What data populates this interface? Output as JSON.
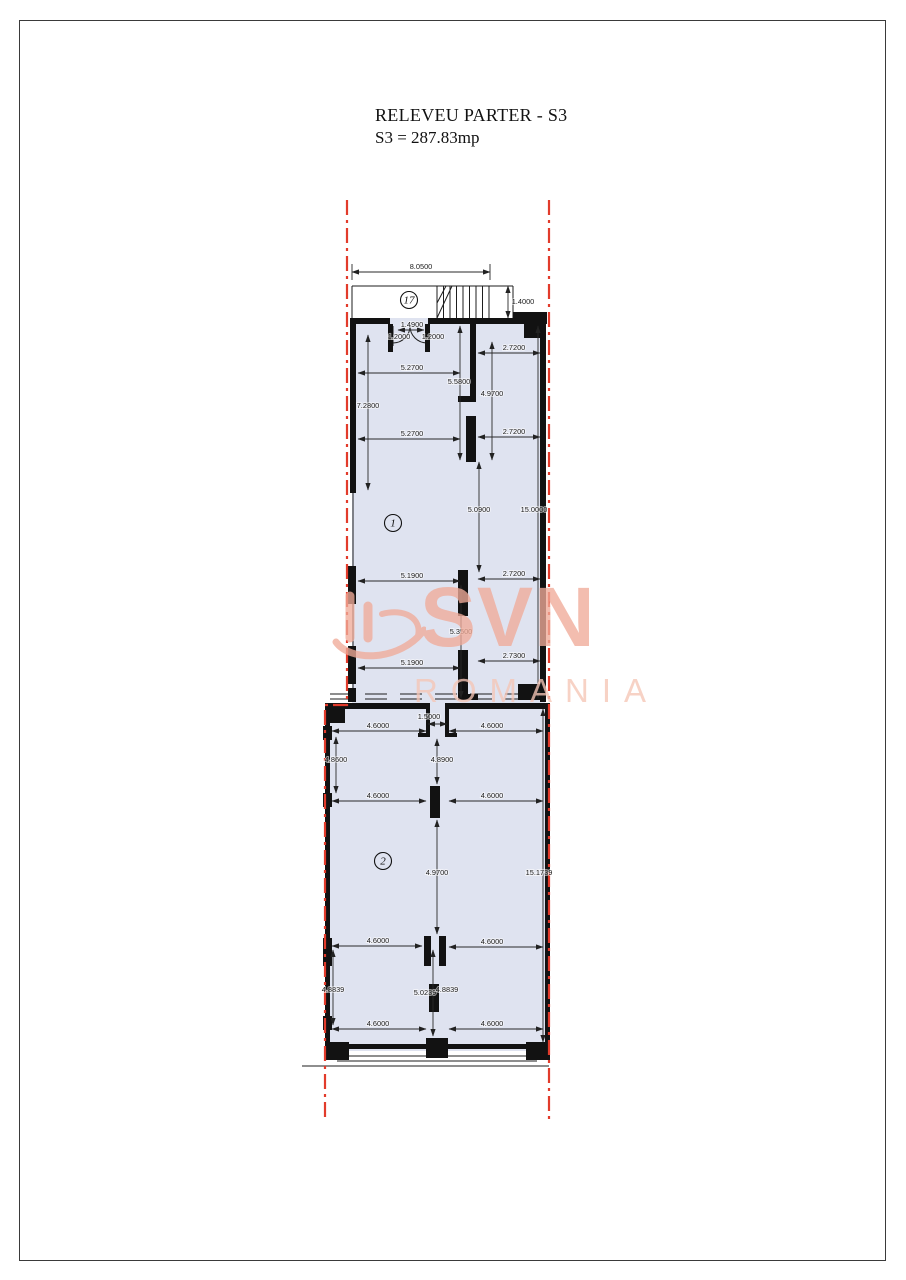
{
  "page": {
    "title_line1": "RELEVEU PARTER - S3",
    "title_line2": "S3 = 287.83mp"
  },
  "watermark": {
    "main": "SVN",
    "sub": "ROMANIA",
    "color_main": "#f0ab99",
    "color_sub": "#f6c6b6"
  },
  "colors": {
    "floor_fill": "#dfe3f0",
    "wall": "#121212",
    "boundary_red": "#e23b2b",
    "dim_line": "#2a2a2a"
  },
  "rooms": [
    {
      "label": "17",
      "x": 409,
      "y": 300
    },
    {
      "label": "1",
      "x": 393,
      "y": 523
    },
    {
      "label": "2",
      "x": 383,
      "y": 861
    }
  ],
  "dimensions": [
    {
      "text": "8.0500",
      "x": 421,
      "y": 269
    },
    {
      "text": "1.4000",
      "x": 523,
      "y": 304
    },
    {
      "text": "1.4900",
      "x": 412,
      "y": 327
    },
    {
      "text": "1.2000",
      "x": 399,
      "y": 339
    },
    {
      "text": "1.2000",
      "x": 433,
      "y": 339
    },
    {
      "text": "2.7200",
      "x": 514,
      "y": 350
    },
    {
      "text": "5.2700",
      "x": 412,
      "y": 370
    },
    {
      "text": "5.5800",
      "x": 459,
      "y": 384
    },
    {
      "text": "4.9700",
      "x": 492,
      "y": 396
    },
    {
      "text": "7.2800",
      "x": 368,
      "y": 408
    },
    {
      "text": "2.7200",
      "x": 514,
      "y": 434
    },
    {
      "text": "5.2700",
      "x": 412,
      "y": 436
    },
    {
      "text": "5.0900",
      "x": 479,
      "y": 512
    },
    {
      "text": "15.0000",
      "x": 534,
      "y": 512
    },
    {
      "text": "2.7200",
      "x": 514,
      "y": 576
    },
    {
      "text": "5.1900",
      "x": 412,
      "y": 578
    },
    {
      "text": "5.3500",
      "x": 461,
      "y": 634
    },
    {
      "text": "2.7300",
      "x": 514,
      "y": 658
    },
    {
      "text": "5.1900",
      "x": 412,
      "y": 665
    },
    {
      "text": "1.5000",
      "x": 429,
      "y": 719
    },
    {
      "text": "4.6000",
      "x": 378,
      "y": 728
    },
    {
      "text": "4.6000",
      "x": 492,
      "y": 728
    },
    {
      "text": "4.8600",
      "x": 336,
      "y": 762
    },
    {
      "text": "4.8900",
      "x": 442,
      "y": 762
    },
    {
      "text": "4.6000",
      "x": 378,
      "y": 798
    },
    {
      "text": "4.6000",
      "x": 492,
      "y": 798
    },
    {
      "text": "4.9700",
      "x": 437,
      "y": 875
    },
    {
      "text": "15.1739",
      "x": 539,
      "y": 875
    },
    {
      "text": "4.6000",
      "x": 378,
      "y": 943
    },
    {
      "text": "4.6000",
      "x": 492,
      "y": 944
    },
    {
      "text": "4.8839",
      "x": 333,
      "y": 992
    },
    {
      "text": "5.0239",
      "x": 425,
      "y": 995
    },
    {
      "text": "4.8839",
      "x": 447,
      "y": 992
    },
    {
      "text": "4.6000",
      "x": 378,
      "y": 1026
    },
    {
      "text": "4.6000",
      "x": 492,
      "y": 1026
    }
  ]
}
